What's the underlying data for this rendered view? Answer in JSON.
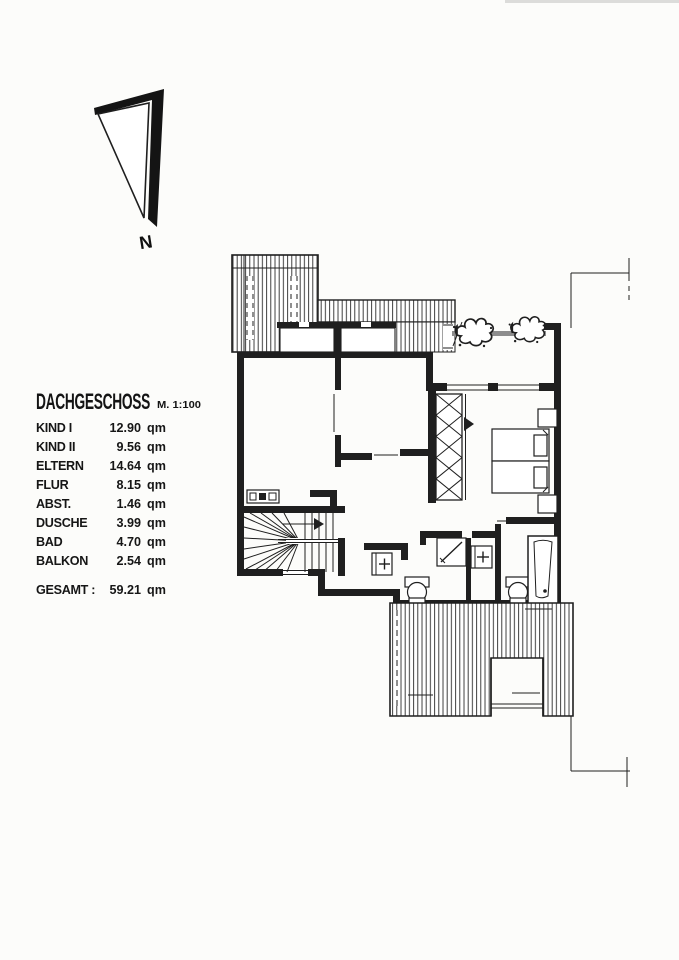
{
  "page": {
    "background": "#fcfcfa",
    "ink": "#1f1f1f"
  },
  "compass": {
    "label": "N"
  },
  "legend": {
    "title": "DACHGESCHOSS",
    "scale": "M. 1:100",
    "rows": [
      {
        "label": "KIND I",
        "value": "12.90",
        "unit": "qm"
      },
      {
        "label": "KIND II",
        "value": "9.56",
        "unit": "qm"
      },
      {
        "label": "ELTERN",
        "value": "14.64",
        "unit": "qm"
      },
      {
        "label": "FLUR",
        "value": "8.15",
        "unit": "qm"
      },
      {
        "label": "ABST.",
        "value": "1.46",
        "unit": "qm"
      },
      {
        "label": "DUSCHE",
        "value": "3.99",
        "unit": "qm"
      },
      {
        "label": "BAD",
        "value": "4.70",
        "unit": "qm"
      },
      {
        "label": "BALKON",
        "value": "2.54",
        "unit": "qm"
      }
    ],
    "total": {
      "label": "GESAMT :",
      "value": "59.21",
      "unit": "qm"
    }
  }
}
